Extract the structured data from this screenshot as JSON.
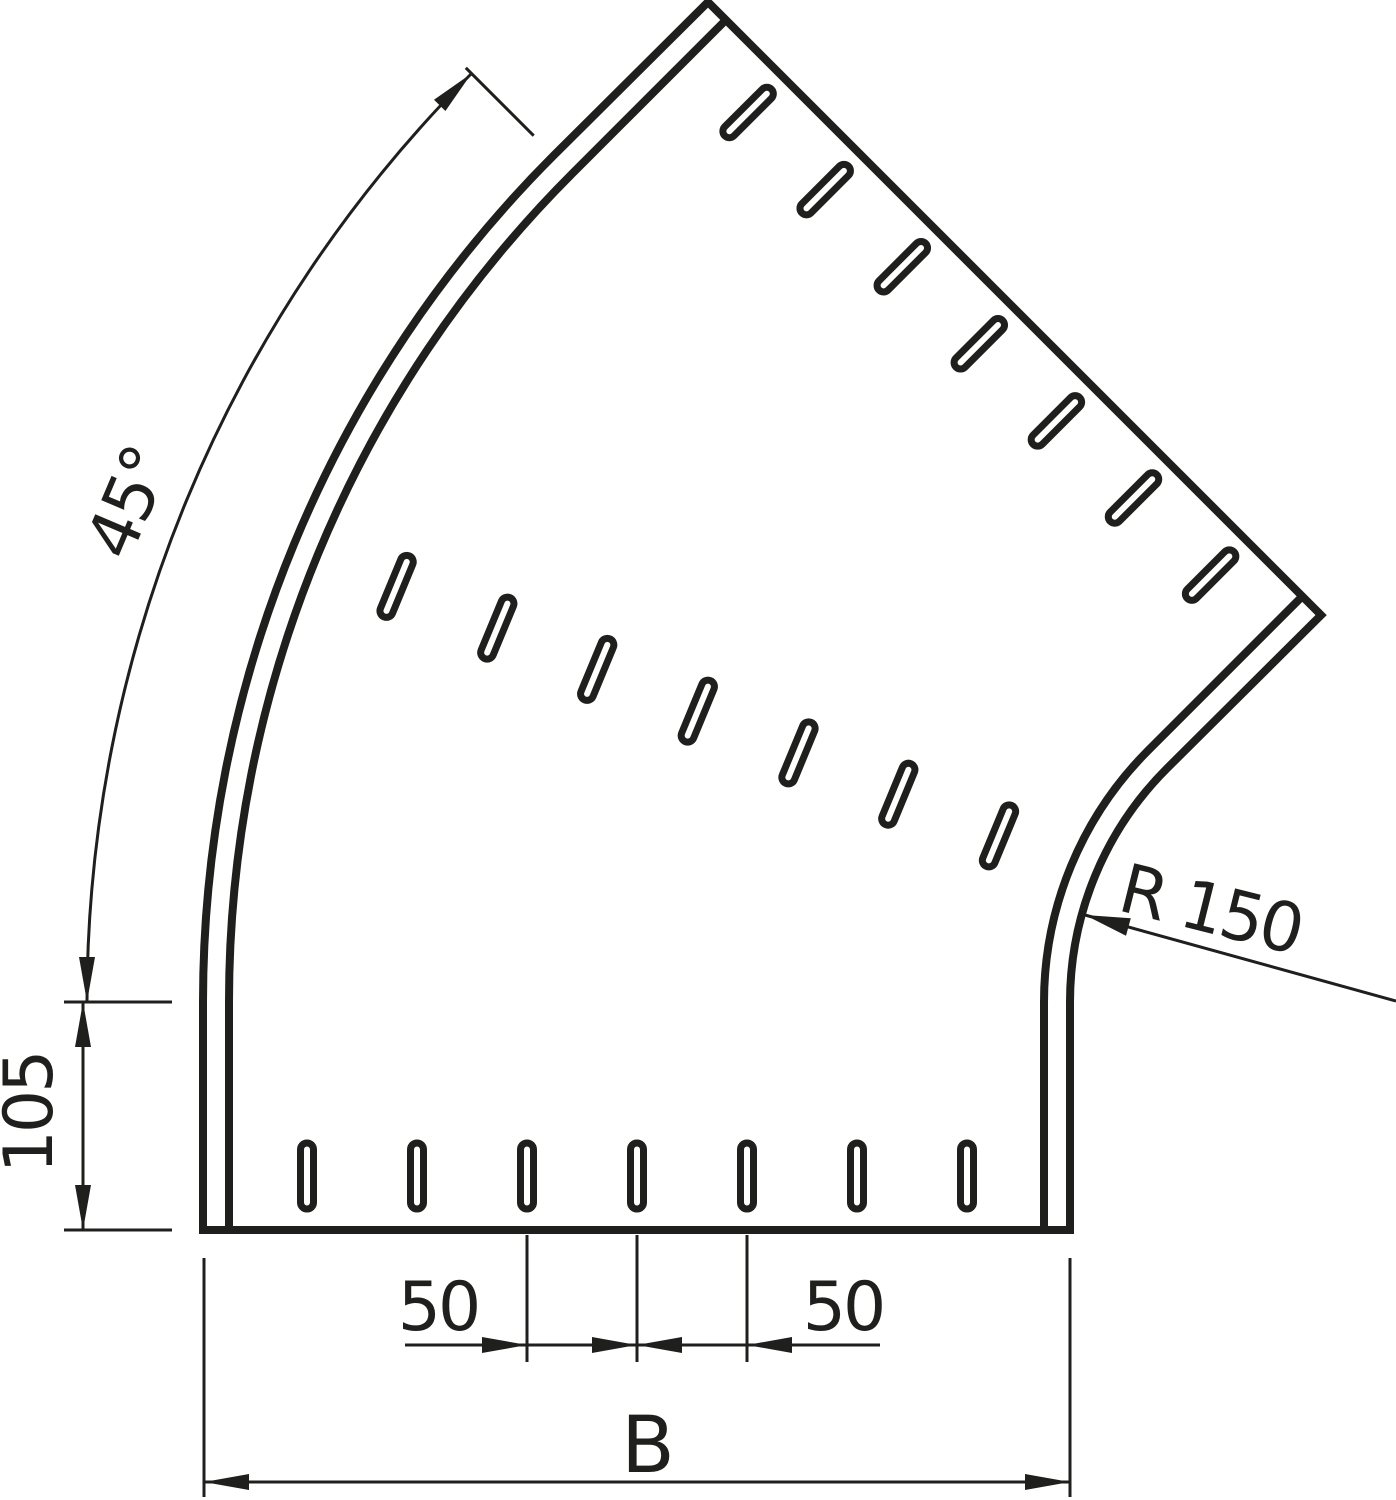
{
  "drawing": {
    "background_color": "#ffffff",
    "line_color": "#1f1f1d",
    "labels": {
      "angle": "45°",
      "straight_end_length": "105",
      "inner_radius": "R 150",
      "slot_pitch_left": "50",
      "slot_pitch_right": "50",
      "overall_width": "B"
    }
  }
}
